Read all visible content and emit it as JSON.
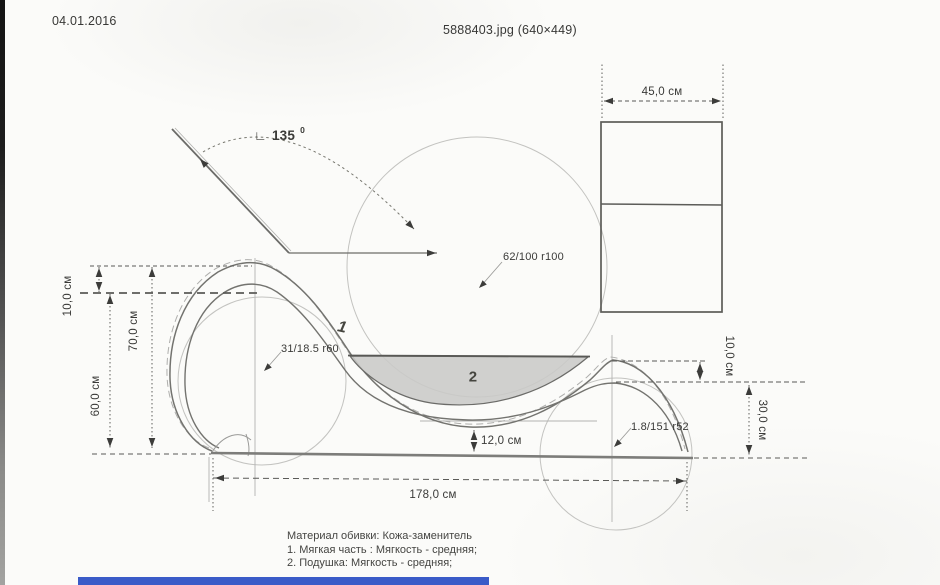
{
  "page": {
    "date": "04.01.2016",
    "title": "5888403.jpg (640×449)"
  },
  "drawing": {
    "angle": {
      "symbol": "∟",
      "value": "135",
      "sup": "0"
    },
    "part_labels": {
      "part1": "1",
      "part2": "2"
    },
    "annotations": {
      "r100": "62/100 r100",
      "r60": "31/18.5 r60",
      "r52": "1.8/151 r52"
    },
    "dimensions": {
      "top_width": "45,0 см",
      "left_offset": "10,0 см",
      "left_height_outer": "70,0 см",
      "left_height_inner": "60,0 см",
      "right_offset": "10,0 см",
      "right_height": "30,0 см",
      "clearance": "12,0 см",
      "total_length": "178,0 см"
    },
    "notes": {
      "line1": "Материал обивки: Кожа-заменитель",
      "line2": "1. Мягкая часть : Мягкость - средняя;",
      "line3": "2. Подушка: Мягкость - средняя;"
    }
  },
  "colors": {
    "paper": "#fbfbf9",
    "line": "#73736f",
    "dimension": "#5a5a57",
    "cushion_fill": "#c9c9c7",
    "accent_blue": "#3a5bc8"
  }
}
